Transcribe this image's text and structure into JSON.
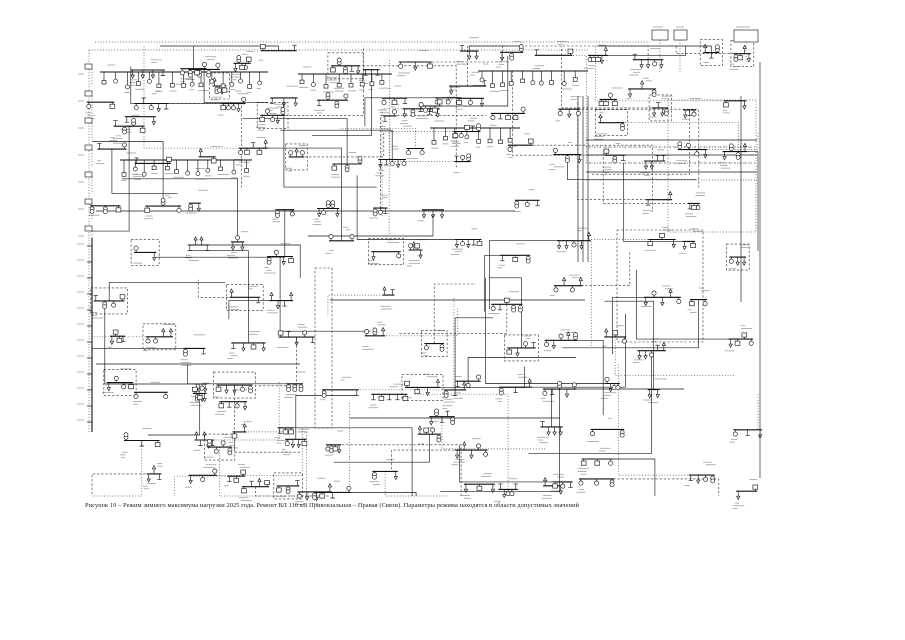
{
  "figure": {
    "number_label": "Рисунок 19",
    "caption": "Рисунок 19 – Режим зимнего максимума нагрузки 2025 года. Ремонт ВЛ 110 кВ Привокзальная – Правая (Связи). Параметры режима находятся в области допустимых значений"
  },
  "diagram": {
    "kind": "power-system-single-line-load-flow-scheme",
    "background_color": "#ffffff",
    "ink_color": "#1a1a1a",
    "bus_color": "#111111",
    "annotation_color": "#9a9a9a",
    "boundary_color": "#2e2e2e",
    "seed": 190525
  }
}
